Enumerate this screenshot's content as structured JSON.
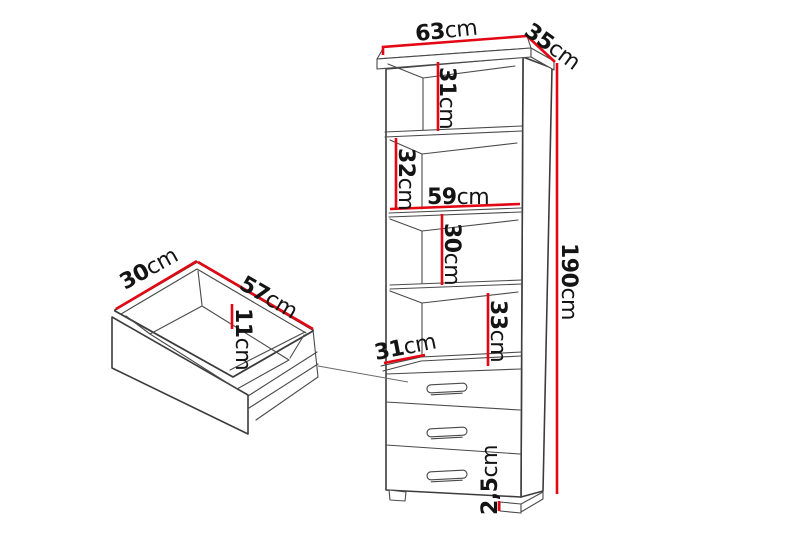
{
  "diagram": {
    "kind": "furniture-dimension-diagram",
    "background": "#ffffff",
    "dimension_color": "#e30613",
    "outline_color": "#3c3c3c",
    "unit": "cm"
  },
  "cabinet": {
    "width": {
      "value": "63",
      "unit": "cm"
    },
    "depth": {
      "value": "35",
      "unit": "cm"
    },
    "height": {
      "value": "190",
      "unit": "cm"
    },
    "top_compartment_height": {
      "value": "31",
      "unit": "cm"
    },
    "second_compartment_height": {
      "value": "32",
      "unit": "cm"
    },
    "shelf_inner_width": {
      "value": "59",
      "unit": "cm"
    },
    "third_compartment_height": {
      "value": "30",
      "unit": "cm"
    },
    "fourth_compartment_height": {
      "value": "33",
      "unit": "cm"
    },
    "drawer_top_depth": {
      "value": "31",
      "unit": "cm"
    },
    "foot_height": {
      "value": "2,5",
      "unit": "cm"
    },
    "drawer_count": 3
  },
  "drawer": {
    "depth": {
      "value": "30",
      "unit": "cm"
    },
    "width": {
      "value": "57",
      "unit": "cm"
    },
    "height": {
      "value": "11",
      "unit": "cm"
    }
  }
}
